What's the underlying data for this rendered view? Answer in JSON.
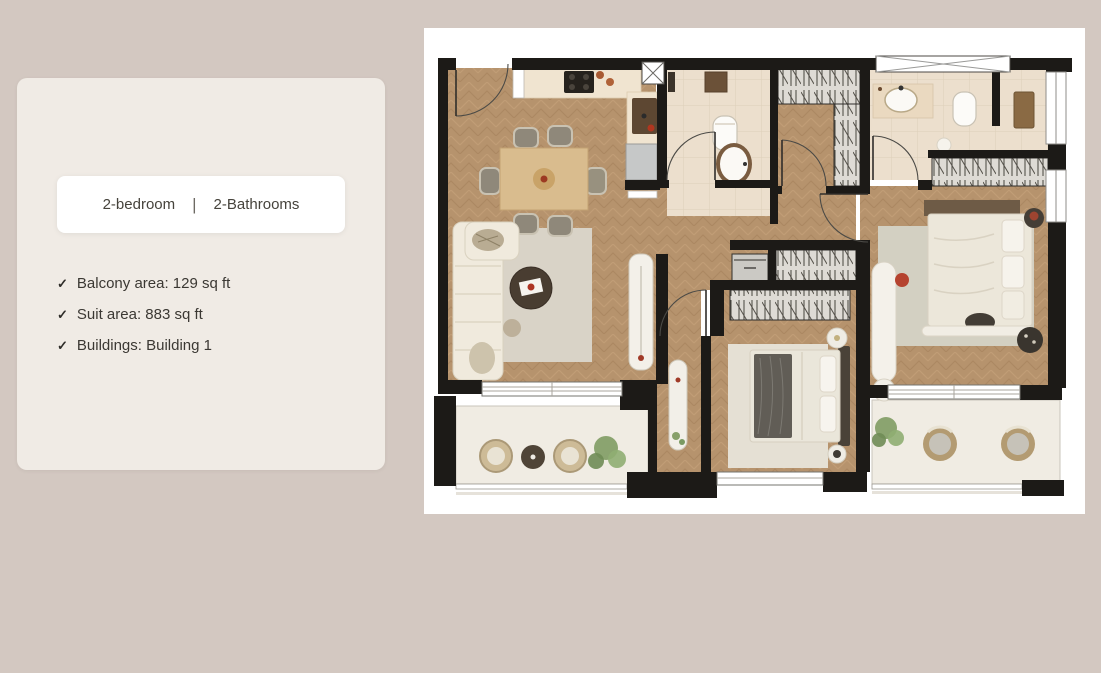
{
  "page": {
    "background_color": "#d3c8c1"
  },
  "summary_card": {
    "background_color": "#f0ebe5",
    "total_area_label": "Total area:",
    "total_area_value": "1,012 sq ft",
    "check_glyph": "✓",
    "type_pill": {
      "bedrooms_label": "2-bedroom",
      "divider": "|",
      "bathrooms_label": "2-Bathrooms"
    },
    "features": [
      {
        "icon": "check",
        "text": "Balcony area: 129 sq ft"
      },
      {
        "icon": "check",
        "text": "Suit area: 883 sq ft"
      },
      {
        "icon": "check",
        "text": "Buildings: Building 1"
      }
    ]
  },
  "floorplan": {
    "description": "Top-down rendered floor plan of a 2-bedroom, 2-bathroom apartment with two balconies",
    "panel_background": "#ffffff",
    "palette": {
      "walls": "#1c1a17",
      "wood_floor": "#b6936d",
      "tile_floor": "#ecdfcd",
      "balcony_floor": "#f0ece3",
      "rug": "#d9d3c7",
      "furniture_cream": "#f0eadd",
      "accent_red": "#a8432c",
      "plant_green": "#85a066"
    }
  }
}
